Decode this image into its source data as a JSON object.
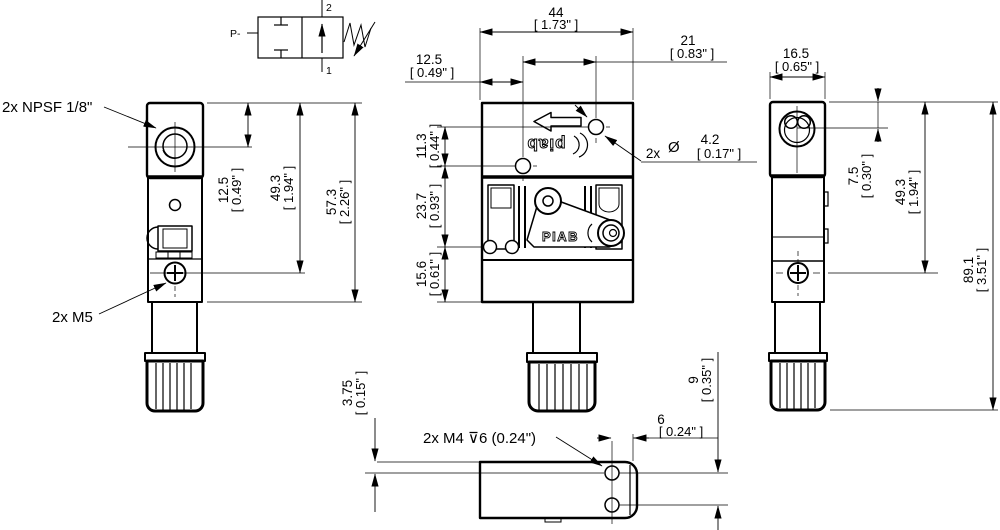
{
  "colors": {
    "ink": "#000000",
    "paper": "#ffffff"
  },
  "valve_symbol": {
    "pressure_port": "P-",
    "port_2": "2",
    "port_1": "1"
  },
  "callouts": {
    "npsf": "2x NPSF 1/8\"",
    "m5": "2x M5",
    "m4": "2x M4 ⊽6 (0.24\")",
    "hole_qty": "2x",
    "dia_symbol": "Ø"
  },
  "logos": {
    "top_face": "piab",
    "label": "PIAB"
  },
  "dims": {
    "w44": {
      "mm": "44",
      "in": "[ 1.73\" ]"
    },
    "w21": {
      "mm": "21",
      "in": "[ 0.83\" ]"
    },
    "w12_5": {
      "mm": "12.5",
      "in": "[ 0.49\" ]"
    },
    "dia4_2": {
      "mm": "4.2",
      "in": "[ 0.17\" ]"
    },
    "h11_3": {
      "mm": "11.3",
      "in": "[ 0.44\" ]"
    },
    "h23_7": {
      "mm": "23.7",
      "in": "[ 0.93\" ]"
    },
    "h15_6": {
      "mm": "15.6",
      "in": "[ 0.61\" ]"
    },
    "h12_5": {
      "mm": "12.5",
      "in": "[ 0.49\" ]"
    },
    "h49_3": {
      "mm": "49.3",
      "in": "[ 1.94\" ]"
    },
    "h57_3": {
      "mm": "57.3",
      "in": "[ 2.26\" ]"
    },
    "w16_5": {
      "mm": "16.5",
      "in": "[ 0.65\" ]"
    },
    "h7_5": {
      "mm": "7.5",
      "in": "[ 0.30\" ]"
    },
    "h49_3r": {
      "mm": "49.3",
      "in": "[ 1.94\" ]"
    },
    "h89_1": {
      "mm": "89.1",
      "in": "[ 3.51\" ]"
    },
    "h3_75": {
      "mm": "3.75",
      "in": "[ 0.15\" ]"
    },
    "w6": {
      "mm": "6",
      "in": "[ 0.24\" ]"
    },
    "h9": {
      "mm": "9",
      "in": "[ 0.35\" ]"
    }
  }
}
